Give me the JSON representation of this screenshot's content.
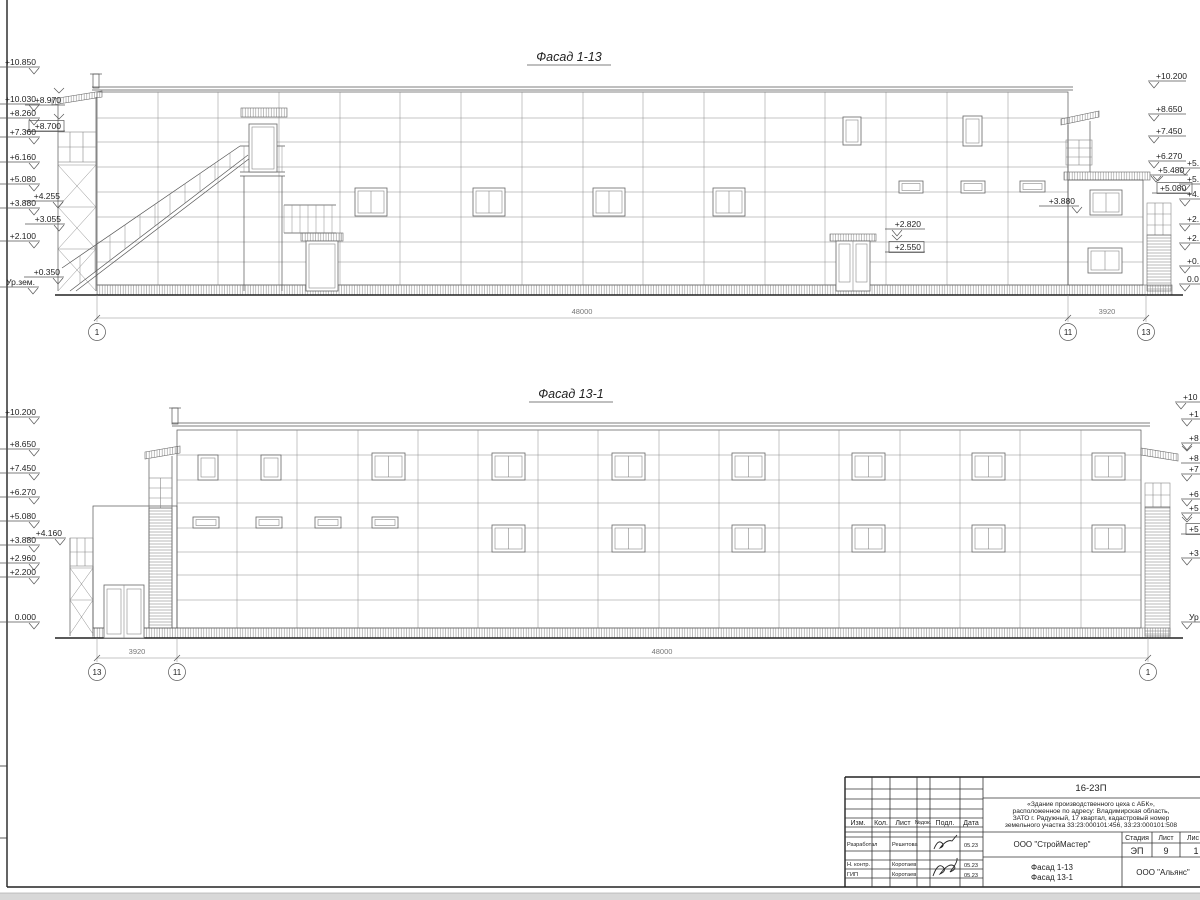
{
  "facade1": {
    "title": "Фасад 1-13",
    "lm": [
      "+10.850",
      "+10.030",
      "+8.970",
      "+8.260",
      "+8.700",
      "+7.360",
      "+6.160",
      "+5.080",
      "+4.255",
      "+3.880",
      "+3.055",
      "+2.100",
      "+0.350",
      "Ур.зем."
    ],
    "rm": [
      "+10.200",
      "+8.650",
      "+7.450",
      "+6.270",
      "+5.480",
      "+5.080"
    ],
    "em": [
      "+5.",
      "+5.",
      "+4.",
      "+2.",
      "+2.",
      "+0.",
      "0.0"
    ],
    "im": [
      "+2.820",
      "+2.550",
      "+3.880"
    ],
    "dim_main": "48000",
    "dim_side": "3920",
    "axes": [
      "1",
      "11",
      "13"
    ]
  },
  "facade2": {
    "title": "Фасад 13-1",
    "lm": [
      "+10.200",
      "+8.650",
      "+7.450",
      "+6.270",
      "+5.080",
      "+4.160",
      "+3.880",
      "+2.960",
      "+2.200",
      "0.000"
    ],
    "em": [
      "+10",
      "+1",
      "+8",
      "+8",
      "+7",
      "+6",
      "+5",
      "+5",
      "+3",
      "Ур"
    ],
    "dim_main": "48000",
    "dim_side": "3920",
    "axes": [
      "13",
      "11",
      "1"
    ]
  },
  "titleblock": {
    "code": "16-23П",
    "desc1": "«Здание производственного цеха с АБК»,",
    "desc2": "расположенное по адресу: Владимирская область,",
    "desc3": "ЗАТО г. Радужный, 17 квартал, кадастровый номер",
    "desc4": "земельного участка 33:23:000101:456, 33:23:000101:508",
    "col_izm": "Изм.",
    "col_kol": "Кол.",
    "col_list": "Лист",
    "col_ndok": "№док.",
    "col_podl": "Подл.",
    "col_data": "Дата",
    "row1_role": "Разработал",
    "row1_name": "Решетова",
    "row1_date": "05.23",
    "row2_role": "Н. контр.",
    "row2_name": "Коротаев",
    "row2_date": "05.23",
    "row3_role": "ГИП",
    "row3_name": "Коротаев",
    "row3_date": "05.23",
    "org": "ООО \"СтройМастер\"",
    "stage_label": "Стадия",
    "sheet_label": "Лист",
    "sheets_label": "Лис",
    "stage": "ЭП",
    "sheet": "9",
    "sheets": "1",
    "name1": "Фасад 1-13",
    "name2": "Фасад 13-1",
    "company": "ООО \"Альянс\""
  }
}
